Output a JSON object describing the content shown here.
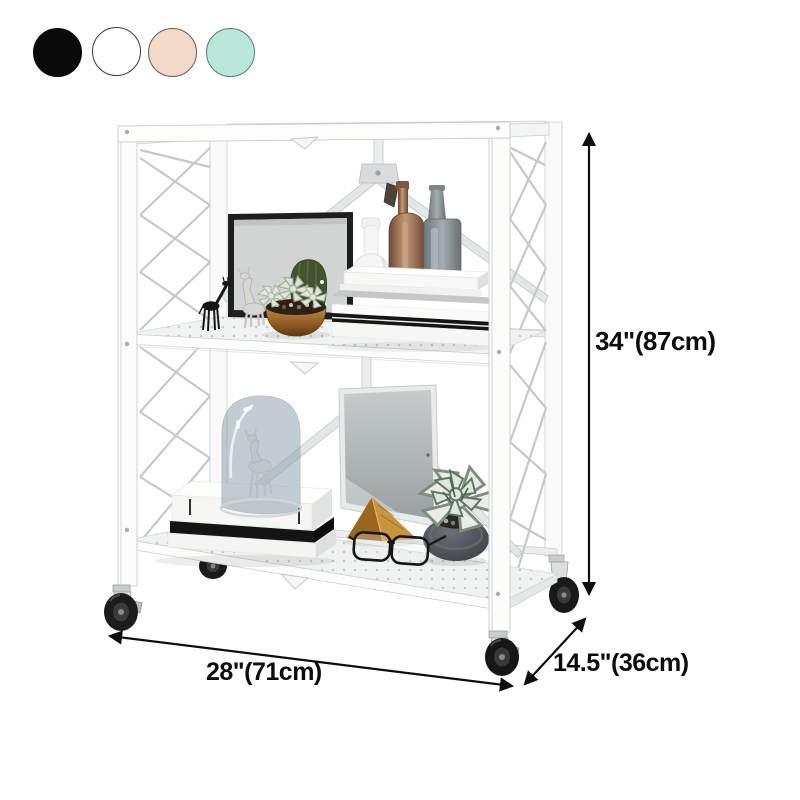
{
  "color_options": {
    "swatches": [
      {
        "name": "black",
        "hex": "#0a0a0a",
        "border": "#0a0a0a"
      },
      {
        "name": "white",
        "hex": "#ffffff",
        "border": "#3a3a3a"
      },
      {
        "name": "blush-pink",
        "hex": "#f3d9c9",
        "border": "#6d5a50"
      },
      {
        "name": "mint-green",
        "hex": "#b9e8da",
        "border": "#4f7d72"
      }
    ]
  },
  "dimension_labels": {
    "height": "34\"(87cm)",
    "width": "28\"(71cm)",
    "depth": "14.5\"(36cm)",
    "annotation_color": "#0d0d0d"
  }
}
